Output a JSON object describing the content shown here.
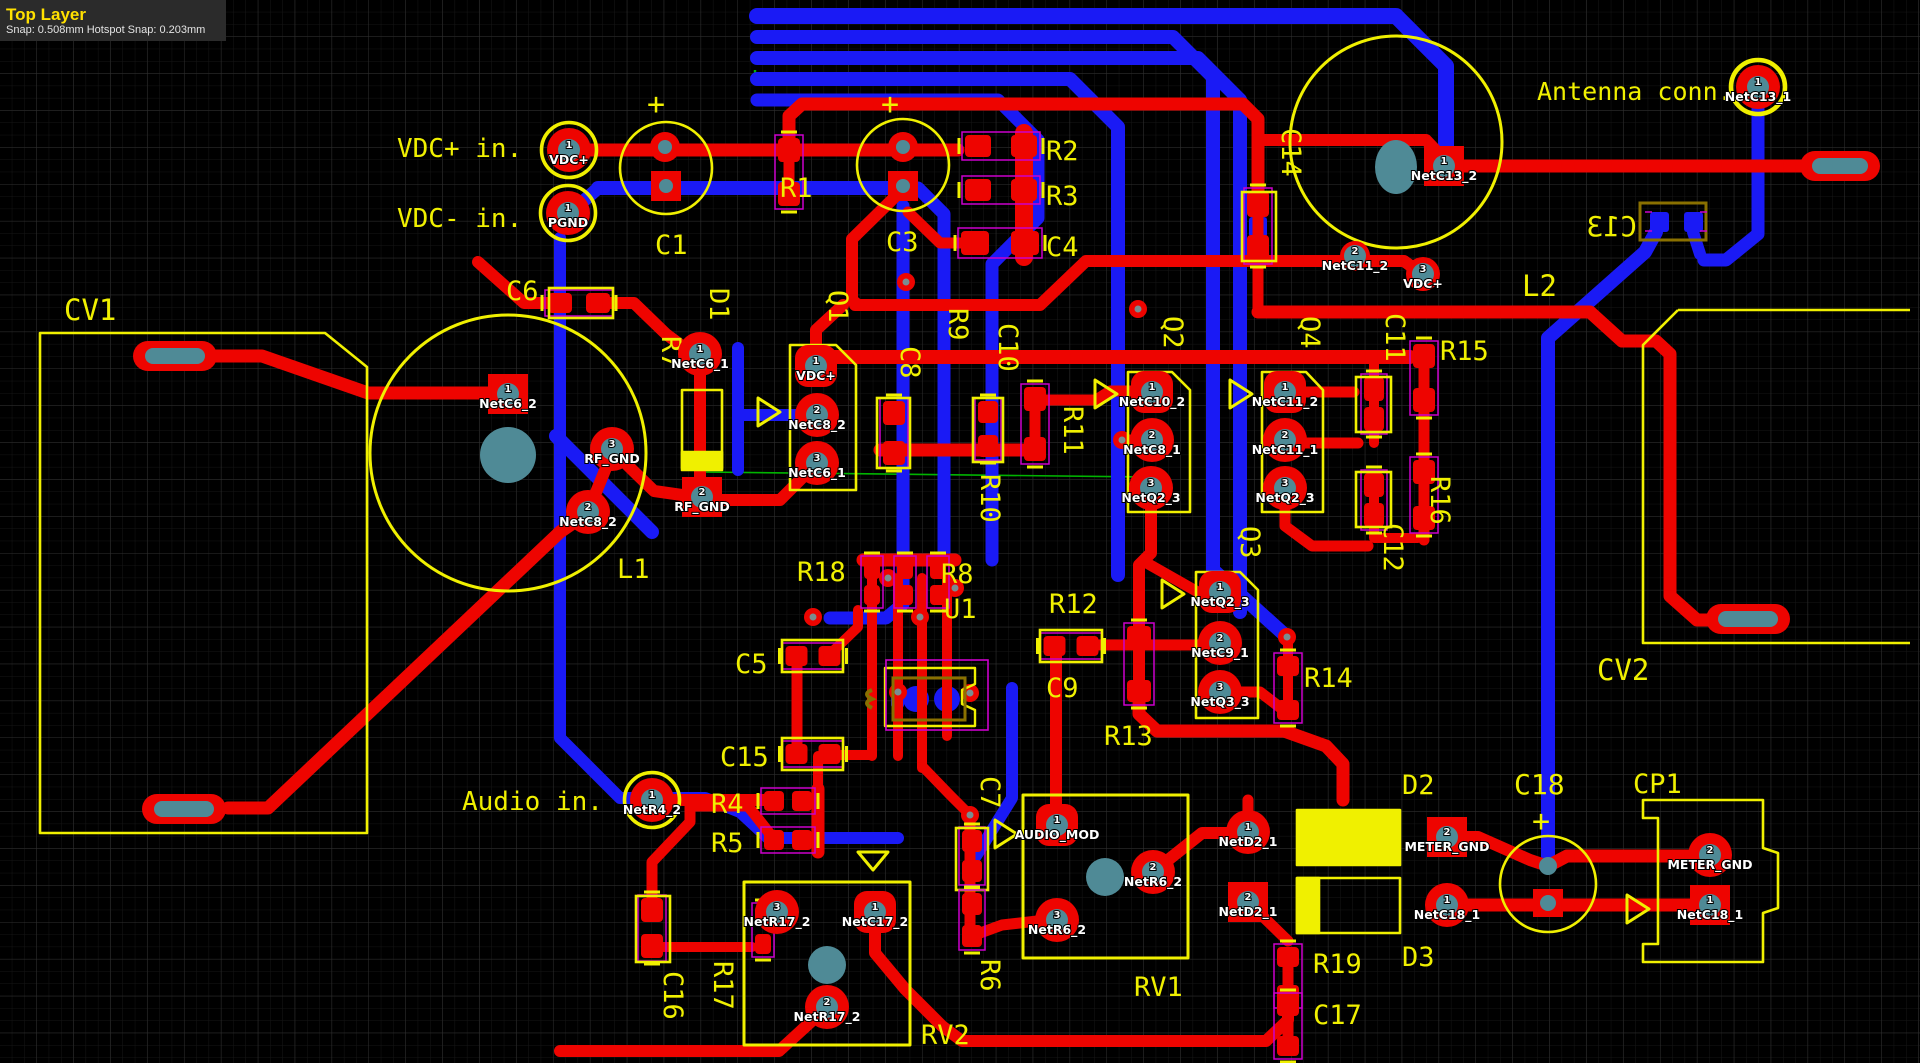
{
  "header": {
    "layer_name": "Top Layer",
    "snap_info": "Snap: 0.508mm Hotspot Snap: 0.203mm"
  },
  "colors": {
    "top_copper": "#ee0400",
    "bottom_copper": "#1a1af5",
    "silkscreen": "#f0f000",
    "bottom_silkscreen": "#8a7000",
    "drill": "#4f8a96",
    "component_outline": "#cc00cc",
    "ratsnest": "#00b400",
    "background": "#000000"
  },
  "labels": [
    {
      "text": "VDC+ in.",
      "x": 397,
      "y": 157,
      "size": 26
    },
    {
      "text": "VDC- in.",
      "x": 397,
      "y": 227,
      "size": 26
    },
    {
      "text": "Audio in.",
      "x": 462,
      "y": 810,
      "size": 26
    },
    {
      "text": "Antenna conn.",
      "x": 1537,
      "y": 100,
      "size": 25
    },
    {
      "text": "C1",
      "x": 655,
      "y": 254,
      "size": 27
    },
    {
      "text": "C3",
      "x": 886,
      "y": 251,
      "size": 27
    },
    {
      "text": "C4",
      "x": 1046,
      "y": 256,
      "size": 27
    },
    {
      "text": "R1",
      "x": 780,
      "y": 197,
      "size": 27
    },
    {
      "text": "R2",
      "x": 1046,
      "y": 160,
      "size": 27
    },
    {
      "text": "R3",
      "x": 1046,
      "y": 205,
      "size": 27
    },
    {
      "text": "C6",
      "x": 506,
      "y": 300,
      "size": 27
    },
    {
      "text": "CV1",
      "x": 64,
      "y": 320,
      "size": 29
    },
    {
      "text": "CV2",
      "x": 1597,
      "y": 680,
      "size": 29
    },
    {
      "text": "D1",
      "x": 710,
      "y": 288,
      "size": 27,
      "rot": 90
    },
    {
      "text": "R7",
      "x": 662,
      "y": 336,
      "size": 27,
      "rot": 90
    },
    {
      "text": "Q1",
      "x": 829,
      "y": 290,
      "size": 27,
      "rot": 90
    },
    {
      "text": "C8",
      "x": 901,
      "y": 346,
      "size": 27,
      "rot": 90
    },
    {
      "text": "R9",
      "x": 949,
      "y": 308,
      "size": 27,
      "rot": 90
    },
    {
      "text": "C10",
      "x": 999,
      "y": 323,
      "size": 27,
      "rot": 90
    },
    {
      "text": "R10",
      "x": 981,
      "y": 474,
      "size": 27,
      "rot": 90
    },
    {
      "text": "R11",
      "x": 1064,
      "y": 406,
      "size": 27,
      "rot": 90
    },
    {
      "text": "Q2",
      "x": 1164,
      "y": 316,
      "size": 27,
      "rot": 90
    },
    {
      "text": "Q4",
      "x": 1301,
      "y": 316,
      "size": 27,
      "rot": 90
    },
    {
      "text": "C11",
      "x": 1386,
      "y": 313,
      "size": 27,
      "rot": 90
    },
    {
      "text": "R15",
      "x": 1440,
      "y": 360,
      "size": 27
    },
    {
      "text": "R16",
      "x": 1431,
      "y": 476,
      "size": 27,
      "rot": 90
    },
    {
      "text": "C12",
      "x": 1384,
      "y": 523,
      "size": 27,
      "rot": 90
    },
    {
      "text": "Q3",
      "x": 1241,
      "y": 526,
      "size": 27,
      "rot": 90
    },
    {
      "text": "L1",
      "x": 617,
      "y": 578,
      "size": 27
    },
    {
      "text": "L2",
      "x": 1522,
      "y": 296,
      "size": 29
    },
    {
      "text": "R18",
      "x": 797,
      "y": 581,
      "size": 27
    },
    {
      "text": "R8",
      "x": 941,
      "y": 583,
      "size": 27
    },
    {
      "text": "U1",
      "x": 944,
      "y": 618,
      "size": 27
    },
    {
      "text": "R12",
      "x": 1049,
      "y": 613,
      "size": 27
    },
    {
      "text": "C9",
      "x": 1046,
      "y": 697,
      "size": 27
    },
    {
      "text": "C5",
      "x": 735,
      "y": 673,
      "size": 27
    },
    {
      "text": "C15",
      "x": 720,
      "y": 766,
      "size": 27
    },
    {
      "text": "R4",
      "x": 711,
      "y": 813,
      "size": 27
    },
    {
      "text": "R5",
      "x": 711,
      "y": 852,
      "size": 27
    },
    {
      "text": "C16",
      "x": 664,
      "y": 971,
      "size": 27,
      "rot": 90
    },
    {
      "text": "R17",
      "x": 714,
      "y": 961,
      "size": 27,
      "rot": 90
    },
    {
      "text": "RV2",
      "x": 921,
      "y": 1044,
      "size": 27
    },
    {
      "text": "R6",
      "x": 981,
      "y": 959,
      "size": 27,
      "rot": 90
    },
    {
      "text": "C7",
      "x": 981,
      "y": 776,
      "size": 27,
      "rot": 90
    },
    {
      "text": "RV1",
      "x": 1134,
      "y": 996,
      "size": 27
    },
    {
      "text": "R13",
      "x": 1104,
      "y": 745,
      "size": 27
    },
    {
      "text": "R14",
      "x": 1304,
      "y": 687,
      "size": 27
    },
    {
      "text": "D2",
      "x": 1402,
      "y": 794,
      "size": 27
    },
    {
      "text": "D3",
      "x": 1402,
      "y": 966,
      "size": 27
    },
    {
      "text": "R19",
      "x": 1313,
      "y": 973,
      "size": 27
    },
    {
      "text": "C17",
      "x": 1313,
      "y": 1024,
      "size": 27
    },
    {
      "text": "C18",
      "x": 1514,
      "y": 794,
      "size": 28
    },
    {
      "text": "CP1",
      "x": 1633,
      "y": 793,
      "size": 27
    },
    {
      "text": "C14",
      "x": 1282,
      "y": 128,
      "size": 27,
      "rot": 90
    },
    {
      "text": "+",
      "x": 647,
      "y": 114,
      "size": 30
    },
    {
      "text": "+",
      "x": 881,
      "y": 114,
      "size": 30
    },
    {
      "text": "+",
      "x": 1532,
      "y": 831,
      "size": 30
    },
    {
      "text": "C13",
      "x": 1637,
      "y": 236,
      "size": 28,
      "mirror": true,
      "color": "#8a7000"
    }
  ],
  "pads": [
    {
      "x": 569,
      "y": 150,
      "pin": "1",
      "net": "VDC+",
      "shape": "r",
      "ring": true
    },
    {
      "x": 568,
      "y": 213,
      "pin": "1",
      "net": "PGND",
      "shape": "r",
      "ring": true
    },
    {
      "x": 508,
      "y": 394,
      "pin": "1",
      "net": "NetC6_2",
      "shape": "s"
    },
    {
      "x": 588,
      "y": 512,
      "pin": "2",
      "net": "NetC8_2",
      "shape": "r"
    },
    {
      "x": 612,
      "y": 449,
      "pin": "3",
      "net": "RF_GND",
      "shape": "r"
    },
    {
      "x": 700,
      "y": 354,
      "pin": "1",
      "net": "NetC6_1",
      "shape": "r"
    },
    {
      "x": 702,
      "y": 497,
      "pin": "2",
      "net": "RF_GND",
      "shape": "s"
    },
    {
      "x": 816,
      "y": 366,
      "pin": "1",
      "net": "VDC+",
      "shape": "rs"
    },
    {
      "x": 817,
      "y": 415,
      "pin": "2",
      "net": "NetC8_2",
      "shape": "r"
    },
    {
      "x": 817,
      "y": 463,
      "pin": "3",
      "net": "NetC6_1",
      "shape": "r"
    },
    {
      "x": 1152,
      "y": 392,
      "pin": "1",
      "net": "NetC10_2",
      "shape": "rs"
    },
    {
      "x": 1152,
      "y": 440,
      "pin": "2",
      "net": "NetC8_1",
      "shape": "r"
    },
    {
      "x": 1151,
      "y": 488,
      "pin": "3",
      "net": "NetQ2_3",
      "shape": "r"
    },
    {
      "x": 1285,
      "y": 392,
      "pin": "1",
      "net": "NetC11_2",
      "shape": "rs"
    },
    {
      "x": 1285,
      "y": 440,
      "pin": "2",
      "net": "NetC11_1",
      "shape": "r"
    },
    {
      "x": 1285,
      "y": 488,
      "pin": "3",
      "net": "NetQ2_3",
      "shape": "r"
    },
    {
      "x": 1220,
      "y": 592,
      "pin": "1",
      "net": "NetQ2_3",
      "shape": "rs"
    },
    {
      "x": 1220,
      "y": 643,
      "pin": "2",
      "net": "NetC9_1",
      "shape": "r"
    },
    {
      "x": 1220,
      "y": 692,
      "pin": "3",
      "net": "NetQ3_3",
      "shape": "r"
    },
    {
      "x": 1355,
      "y": 256,
      "pin": "2",
      "net": "NetC11_2",
      "shape": "r",
      "pr": 15
    },
    {
      "x": 1423,
      "y": 274,
      "pin": "3",
      "net": "VDC+",
      "shape": "r",
      "pr": 17
    },
    {
      "x": 1444,
      "y": 166,
      "pin": "1",
      "net": "NetC13_2",
      "shape": "s"
    },
    {
      "x": 1758,
      "y": 87,
      "pin": "1",
      "net": "NetC13_1",
      "shape": "r",
      "ring": true
    },
    {
      "x": 652,
      "y": 800,
      "pin": "1",
      "net": "NetR4_2",
      "shape": "r",
      "ring": true
    },
    {
      "x": 777,
      "y": 912,
      "pin": "3",
      "net": "NetR17_2",
      "shape": "r"
    },
    {
      "x": 875,
      "y": 912,
      "pin": "1",
      "net": "NetC17_2",
      "shape": "rs"
    },
    {
      "x": 827,
      "y": 1007,
      "pin": "2",
      "net": "NetR17_2",
      "shape": "r"
    },
    {
      "x": 1057,
      "y": 825,
      "pin": "1",
      "net": "AUDIO_MOD",
      "shape": "rs"
    },
    {
      "x": 1153,
      "y": 872,
      "pin": "2",
      "net": "NetR6_2",
      "shape": "r"
    },
    {
      "x": 1057,
      "y": 920,
      "pin": "3",
      "net": "NetR6_2",
      "shape": "r"
    },
    {
      "x": 1248,
      "y": 832,
      "pin": "1",
      "net": "NetD2_1",
      "shape": "r"
    },
    {
      "x": 1248,
      "y": 902,
      "pin": "2",
      "net": "NetD2_1",
      "shape": "s"
    },
    {
      "x": 1447,
      "y": 837,
      "pin": "2",
      "net": "METER_GND",
      "shape": "s"
    },
    {
      "x": 1447,
      "y": 905,
      "pin": "1",
      "net": "NetC18_1",
      "shape": "r"
    },
    {
      "x": 1710,
      "y": 855,
      "pin": "2",
      "net": "METER_GND",
      "shape": "r"
    },
    {
      "x": 1710,
      "y": 905,
      "pin": "1",
      "net": "NetC18_1",
      "shape": "s"
    }
  ]
}
